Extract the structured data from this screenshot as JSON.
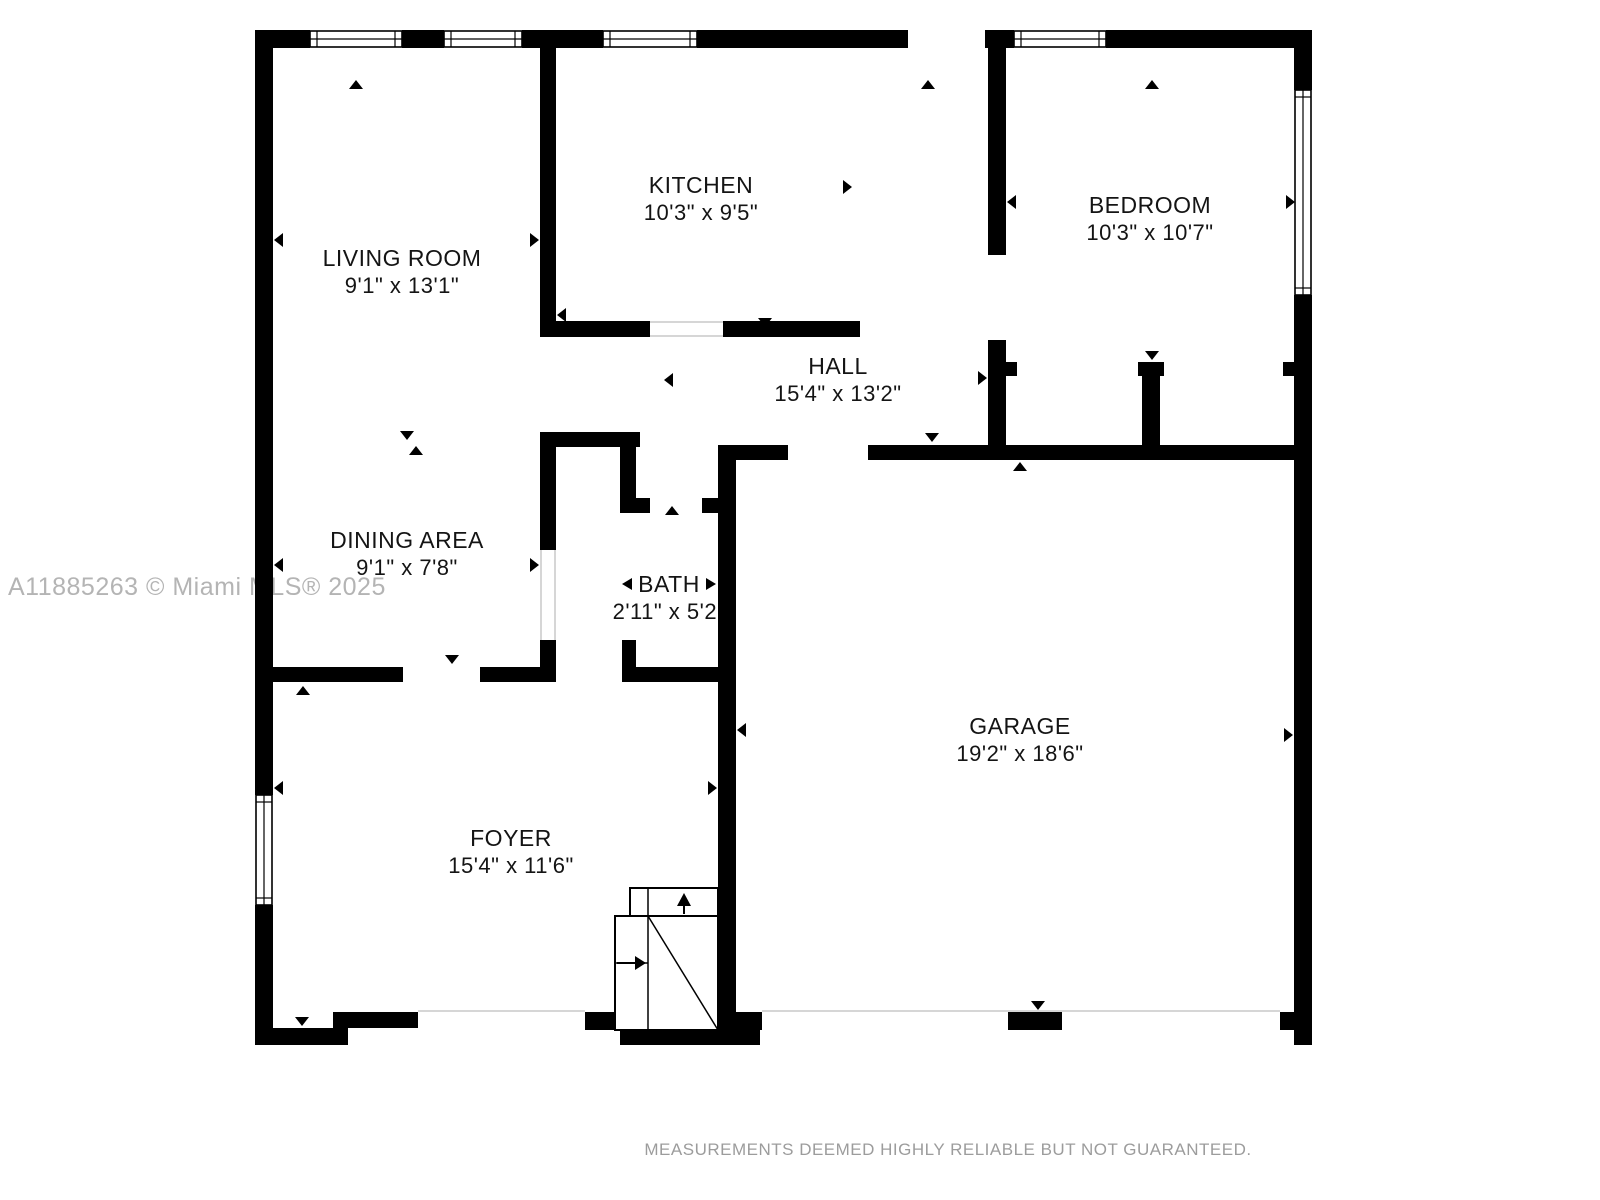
{
  "watermark": "A11885263 © Miami MLS® 2025",
  "disclaimer": "MEASUREMENTS DEEMED HIGHLY RELIABLE BUT NOT GUARANTEED.",
  "colors": {
    "wall": "#000000",
    "background": "#ffffff",
    "watermark_text": "#b4b4b4",
    "disclaimer_text": "#9c9c9c",
    "label_text": "#141414",
    "opening_line": "#c8c8c8"
  },
  "rooms": [
    {
      "id": "living-room",
      "name": "LIVING ROOM",
      "dimensions": "9'1\" x 13'1\""
    },
    {
      "id": "kitchen",
      "name": "KITCHEN",
      "dimensions": "10'3\" x 9'5\""
    },
    {
      "id": "bedroom",
      "name": "BEDROOM",
      "dimensions": "10'3\" x 10'7\""
    },
    {
      "id": "hall",
      "name": "HALL",
      "dimensions": "15'4\" x 13'2\""
    },
    {
      "id": "dining-area",
      "name": "DINING AREA",
      "dimensions": "9'1\" x 7'8\""
    },
    {
      "id": "bath",
      "name": "BATH",
      "dimensions": "2'11\" x 5'2\""
    },
    {
      "id": "garage",
      "name": "GARAGE",
      "dimensions": "19'2\" x 18'6\""
    },
    {
      "id": "foyer",
      "name": "FOYER",
      "dimensions": "15'4\" x 11'6\""
    }
  ]
}
